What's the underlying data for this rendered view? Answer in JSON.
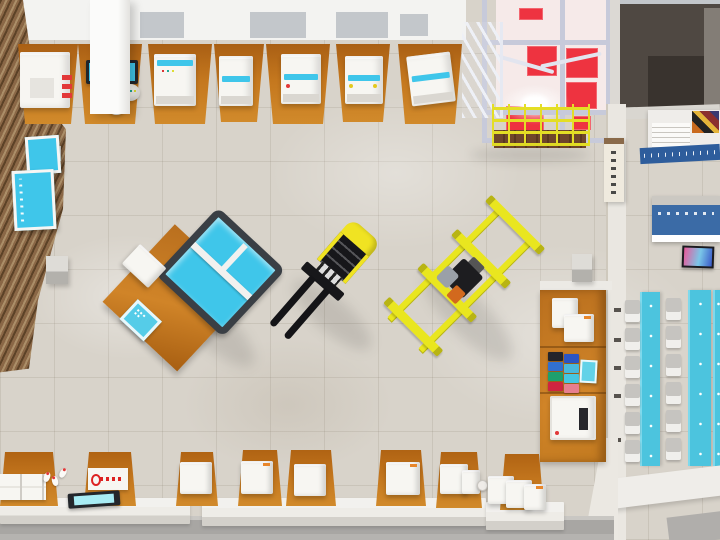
{
  "scene": {
    "description": "Bird's-eye 3D render of a vocational training workshop: equipment benches along the walls, a forklift, a yellow pallet trolley and a laser-cutting station on the tiled floor, a red-panelled mezzanine platform with staircase and yellow safety railing, a supply shelf, and an adjoining corridor with notice boards and a classroom with cyan tables",
    "view": "top-down",
    "canvas": {
      "width": 720,
      "height": 540
    }
  },
  "palette": {
    "floor": "#d8d3ca",
    "floor_line": "rgba(125,115,98,0.16)",
    "ceiling_white": "#f3f3f1",
    "ceiling_gray": "#c3c7cb",
    "wood_dark": "#5c4227",
    "wood_mid": "#8a6746",
    "wood_light": "#ab8e68",
    "bench_orange": "#c4771e",
    "bench_orange_deep": "#9a5a12",
    "machine_white": "#f7f6f2",
    "machine_shade": "#dad7d1",
    "accent_cyan": "#3fc6ea",
    "accent_cyan_deep": "#18a8d2",
    "signal_red": "#e23838",
    "mezz_back": "#f6eae9",
    "mezz_red": "#ee3340",
    "mezz_frame": "#c7cada",
    "railing_yellow": "#e4de25",
    "stair_white": "#eef0f6",
    "forklift_yellow": "#f0e322",
    "vehicle_black": "#17171a",
    "trolley_yellow": "#e9e61f",
    "pump_orange": "#d2691e",
    "wall_gray": "#eae7e1",
    "wall_edge": "#cfc9bd",
    "dark_room": "#4f4842",
    "dark_room_deep": "#39332e",
    "banner_blue": "#2e5d9c",
    "display_blue": "#3b6ba6",
    "counter_white": "#eeece7",
    "counter_shade": "#d3d0ca",
    "walkway_gray": "#a8a6a3",
    "walkway_light": "#c9c7c3",
    "table_cyan": "#4cc4de",
    "chair_gray": "#c6c4c0",
    "chair_seat": "#f0efec",
    "sign_cream": "#efeade",
    "tv_pink": "#e85a9a",
    "tv_cyan": "#7ac6e8",
    "tv_blue": "#3a5ac8"
  },
  "objects": {
    "top_bench_row": {
      "count": 7,
      "label": "equipment benches with white machines"
    },
    "left_wall": {
      "material": "wood slats",
      "notice_boards": 2
    },
    "mezzanine": {
      "red_panels": 6,
      "features": [
        "staircase",
        "yellow safety railing",
        "work light",
        "wood deck strip"
      ]
    },
    "vehicles": [
      {
        "name": "laser-cutter station on orange table",
        "accent": "#3fc6ea"
      },
      {
        "name": "forklift",
        "accent": "#f0e322"
      },
      {
        "name": "pallet trolley frame",
        "accent": "#e9e61f"
      }
    ],
    "supply_shelf": {
      "white_units": 3,
      "colored_boxes": 8,
      "box_colors": [
        "#23242b",
        "#2b55c4",
        "#3170cf",
        "#49b9dd",
        "#1ea06e",
        "#46c7e2",
        "#cf2440",
        "#e77e8e"
      ]
    },
    "bottom_stations": {
      "count": 8,
      "label": "workstations with white machine boxes"
    },
    "corridor": {
      "items": [
        "dark storage room",
        "poster board",
        "blue banner",
        "column sign",
        "blue info display",
        "wall tv"
      ]
    },
    "classroom": {
      "tables": 3,
      "chairs": 12
    }
  }
}
